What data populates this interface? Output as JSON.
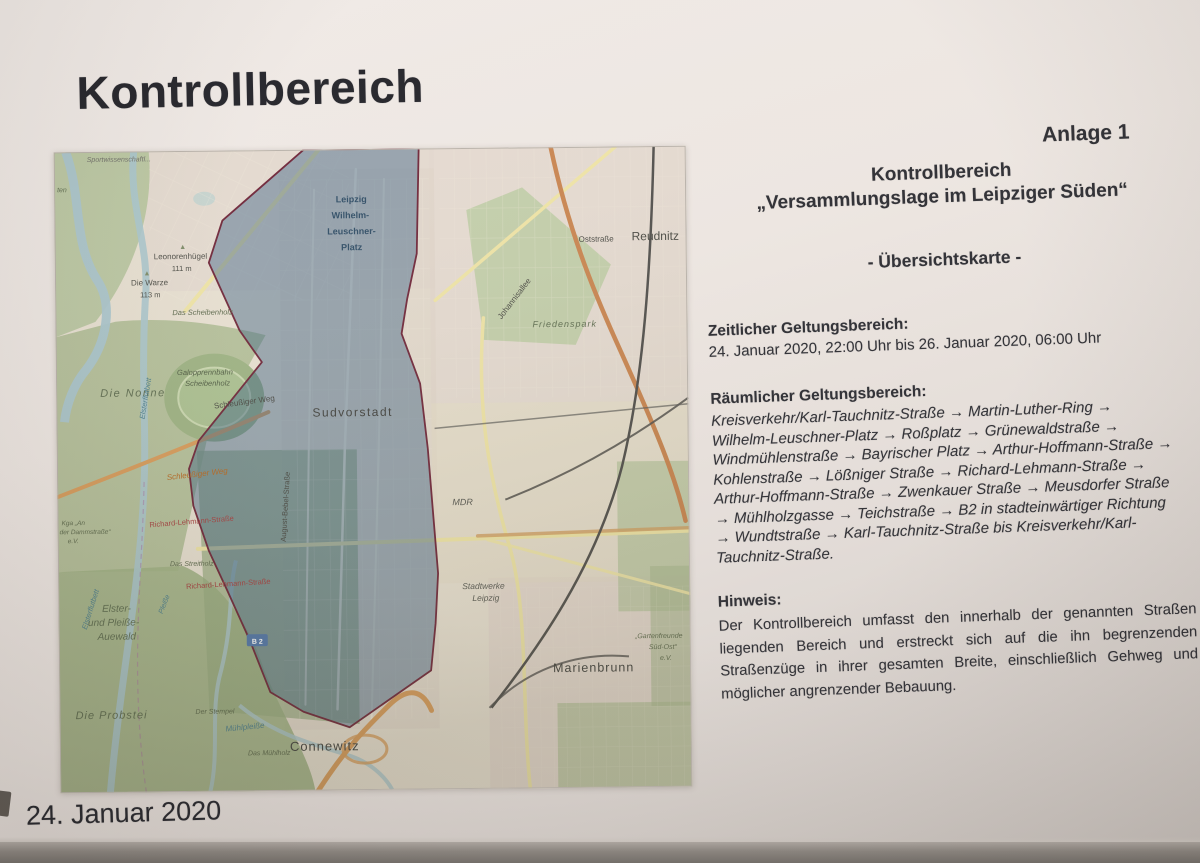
{
  "document": {
    "title": "Kontrollbereich",
    "annex": "Anlage 1",
    "footer_date": "24. Januar 2020",
    "heading": {
      "line1": "Kontrollbereich",
      "line2": "„Versammlungslage im Leipziger Süden“",
      "line3": "- Übersichtskarte -"
    },
    "sections": {
      "zeitlich_label": "Zeitlicher Geltungsbereich:",
      "zeitlich_value": "24. Januar 2020, 22:00 Uhr bis 26. Januar 2020, 06:00 Uhr",
      "raeumlich_label": "Räumlicher Geltungsbereich:",
      "raeumlich_route": "Kreisverkehr/Karl-Tauchnitz-Straße → Martin-Luther-Ring → Wilhelm-Leuschner-Platz → Roßplatz → Grünewaldstraße → Windmühlenstraße → Bayrischer Platz → Arthur-Hoffmann-Straße → Kohlenstraße → Lößniger Straße → Richard-Lehmann-Straße → Arthur-Hoffmann-Straße → Zwenkauer Straße → Meusdorfer Straße → Mühlholzgasse → Teichstraße → B2 in stadteinwärtiger Richtung → Wundtstraße → Karl-Tauchnitz-Straße bis Kreisverkehr/Karl-Tauchnitz-Straße.",
      "hinweis_label": "Hinweis:",
      "hinweis_text": "Der Kontrollbereich umfasst den innerhalb der genannten Straßen liegenden Bereich und erstreckt sich auf die ihn begrenzenden Straßenzüge in ihrer gesamten Breite, einschließlich Gehweg und möglicher angrenzender Bebauung."
    }
  },
  "map": {
    "colors": {
      "control_area_fill": "#345C80",
      "control_area_border": "#6D2336",
      "water": "#A9C4CB",
      "park": "#AABA8F",
      "road_yellow": "#EEE3A4",
      "road_orange": "#D79A58",
      "railway": "#4D4B48"
    },
    "badge": {
      "label": "B 2"
    },
    "labels": [
      {
        "t": "Sportwissenschaftl...",
        "x": 33,
        "y": 10,
        "s": 7,
        "c": "#6f6e67",
        "i": true
      },
      {
        "t": "ten",
        "x": 3,
        "y": 40,
        "s": 7,
        "c": "#5d6b4e",
        "i": true
      },
      {
        "t": "Leipzig",
        "x": 297,
        "y": 53,
        "s": 9,
        "c": "#2c4a63",
        "b": true,
        "a": "middle"
      },
      {
        "t": "Wilhelm-",
        "x": 296,
        "y": 69,
        "s": 9,
        "c": "#2c4a63",
        "b": true,
        "a": "middle"
      },
      {
        "t": "Leuschner-",
        "x": 297,
        "y": 85,
        "s": 9,
        "c": "#2c4a63",
        "b": true,
        "a": "middle"
      },
      {
        "t": "Platz",
        "x": 297,
        "y": 101,
        "s": 9,
        "c": "#2c4a63",
        "b": true,
        "a": "middle"
      },
      {
        "t": "▲",
        "x": 128,
        "y": 98,
        "s": 7,
        "c": "#7c8a66",
        "a": "middle"
      },
      {
        "t": "Leonorenhügel",
        "x": 99,
        "y": 108,
        "s": 8,
        "c": "#4c4c45"
      },
      {
        "t": "111 m",
        "x": 117,
        "y": 120,
        "s": 7.5,
        "c": "#4c4c45"
      },
      {
        "t": "▲",
        "x": 92,
        "y": 124,
        "s": 7,
        "c": "#7c8a66",
        "a": "middle"
      },
      {
        "t": "Die Warze",
        "x": 76,
        "y": 134,
        "s": 8,
        "c": "#4c4c45"
      },
      {
        "t": "113 m",
        "x": 85,
        "y": 146,
        "s": 7.5,
        "c": "#4c4c45"
      },
      {
        "t": "Das Scheibenholz",
        "x": 117,
        "y": 164,
        "s": 7.5,
        "c": "#5a6649",
        "i": true
      },
      {
        "t": "Oststraße",
        "x": 524,
        "y": 95,
        "s": 8,
        "c": "#45453f"
      },
      {
        "t": "Reudnitz",
        "x": 577,
        "y": 94,
        "s": 12,
        "c": "#45453f"
      },
      {
        "t": "Johannisallee",
        "x": 446,
        "y": 172,
        "s": 8,
        "c": "#45453f",
        "r": -52
      },
      {
        "t": "Friedenspark",
        "x": 477,
        "y": 180,
        "s": 9,
        "c": "#5d6b4e",
        "i": true,
        "ls": 1
      },
      {
        "t": "Die Nonne",
        "x": 44,
        "y": 245,
        "s": 11,
        "c": "#5d6b4e",
        "i": true,
        "ls": 1.5
      },
      {
        "t": "Galopprennbahn",
        "x": 121,
        "y": 224,
        "s": 7.5,
        "c": "#4e5a41",
        "i": true
      },
      {
        "t": "Scheibenholz",
        "x": 129,
        "y": 235,
        "s": 7.5,
        "c": "#4e5a41",
        "i": true
      },
      {
        "t": "Schleußiger Weg",
        "x": 158,
        "y": 258,
        "s": 8,
        "c": "#45453f",
        "r": -7
      },
      {
        "t": "Sudvorstadt",
        "x": 256,
        "y": 267,
        "s": 12,
        "c": "#3e3e3a",
        "ls": 1.5
      },
      {
        "t": "Schleußiger Weg",
        "x": 110,
        "y": 329,
        "s": 8,
        "c": "#b5651d",
        "i": true,
        "r": -6
      },
      {
        "t": "MDR",
        "x": 395,
        "y": 357,
        "s": 9,
        "c": "#56564f",
        "i": true
      },
      {
        "t": "August-Bebel-Straße",
        "x": 228,
        "y": 392,
        "s": 7.5,
        "c": "#45453f",
        "r": -86
      },
      {
        "t": "Richard-Lehmann-Straße",
        "x": 92,
        "y": 376,
        "s": 7.5,
        "c": "#a43c3c",
        "r": -4
      },
      {
        "t": "Kga „An",
        "x": 4,
        "y": 373,
        "s": 6.5,
        "c": "#5a6649",
        "i": true
      },
      {
        "t": "der Dammstraße“",
        "x": 2,
        "y": 382,
        "s": 6.5,
        "c": "#5a6649",
        "i": true
      },
      {
        "t": "e.V.",
        "x": 10,
        "y": 391,
        "s": 6.5,
        "c": "#5a6649",
        "i": true
      },
      {
        "t": "Das Streitholz",
        "x": 112,
        "y": 415,
        "s": 7,
        "c": "#5a6649",
        "i": true
      },
      {
        "t": "Richard-Lehmann-Straße",
        "x": 128,
        "y": 438,
        "s": 7.5,
        "c": "#a43c3c",
        "r": -3
      },
      {
        "t": "Stadtwerke",
        "x": 404,
        "y": 441,
        "s": 8.5,
        "c": "#56564f",
        "i": true
      },
      {
        "t": "Leipzig",
        "x": 414,
        "y": 453,
        "s": 8.5,
        "c": "#56564f",
        "i": true
      },
      {
        "t": "Elsterflutbett",
        "x": 88,
        "y": 268,
        "s": 7.5,
        "c": "#4a7d8c",
        "i": true,
        "r": -80
      },
      {
        "t": "Elster-",
        "x": 58,
        "y": 460,
        "s": 10,
        "c": "#5d6b4e",
        "i": true,
        "a": "middle"
      },
      {
        "t": "und Pleiße-",
        "x": 55,
        "y": 474,
        "s": 10,
        "c": "#5d6b4e",
        "i": true,
        "a": "middle"
      },
      {
        "t": "Auewald",
        "x": 58,
        "y": 488,
        "s": 10,
        "c": "#5d6b4e",
        "i": true,
        "a": "middle"
      },
      {
        "t": "Pleiße",
        "x": 104,
        "y": 463,
        "s": 7,
        "c": "#4a7d8c",
        "i": true,
        "r": -68
      },
      {
        "t": "Elsterflutbett",
        "x": 28,
        "y": 478,
        "s": 7.5,
        "c": "#4a7d8c",
        "i": true,
        "r": -72
      },
      {
        "t": "Die Probstei",
        "x": 16,
        "y": 567,
        "s": 11,
        "c": "#5d6b4e",
        "i": true,
        "ls": 1
      },
      {
        "t": "Der Stempel",
        "x": 136,
        "y": 563,
        "s": 7,
        "c": "#5a6649",
        "i": true
      },
      {
        "t": "Mühlpleiße",
        "x": 166,
        "y": 581,
        "s": 8,
        "c": "#4a7d8c",
        "i": true,
        "r": -5
      },
      {
        "t": "Das Mühlholz",
        "x": 188,
        "y": 605,
        "s": 7,
        "c": "#5a6649",
        "i": true
      },
      {
        "t": "Connewitz",
        "x": 230,
        "y": 601,
        "s": 13,
        "c": "#3e3e3a",
        "ls": 1
      },
      {
        "t": "Marienbrunn",
        "x": 494,
        "y": 525,
        "s": 12.5,
        "c": "#3e3e3a",
        "ls": 1
      },
      {
        "t": "„Gartenfreunde",
        "x": 600,
        "y": 492,
        "s": 7,
        "c": "#5a6649",
        "i": true,
        "a": "middle"
      },
      {
        "t": "Süd-Ost“",
        "x": 604,
        "y": 503,
        "s": 7,
        "c": "#5a6649",
        "i": true,
        "a": "middle"
      },
      {
        "t": "e.V.",
        "x": 607,
        "y": 514,
        "s": 7,
        "c": "#5a6649",
        "i": true,
        "a": "middle"
      }
    ]
  }
}
